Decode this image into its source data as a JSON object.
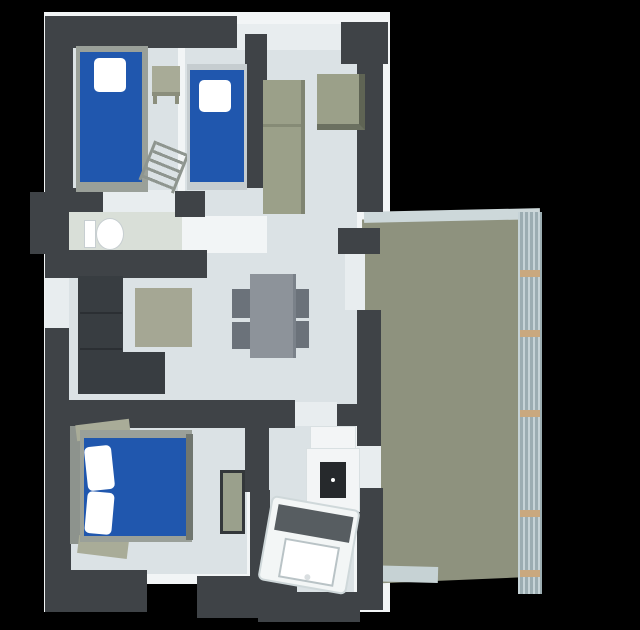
{
  "scene": {
    "type": "3d-floor-plan-render",
    "view": "top-down axonometric",
    "rooms": [
      {
        "name": "bedroom-top-left",
        "furniture": [
          "single-bed-blue",
          "white-pillow",
          "nightstand",
          "ladder"
        ]
      },
      {
        "name": "bedroom-top-middle",
        "furniture": [
          "single-bed-blue",
          "white-pillow"
        ]
      },
      {
        "name": "hallway-closet",
        "furniture": [
          "wardrobe-olive",
          "cabinet-olive"
        ]
      },
      {
        "name": "bathroom-small",
        "furniture": [
          "toilet"
        ]
      },
      {
        "name": "living-dining-room",
        "furniture": [
          "l-shaped-sofa-dark",
          "rug-olive",
          "dining-table",
          "chair",
          "chair",
          "chair",
          "chair"
        ]
      },
      {
        "name": "bedroom-bottom",
        "furniture": [
          "double-bed-blue",
          "white-pillow",
          "white-pillow",
          "bench-cabinet"
        ]
      },
      {
        "name": "kitchen",
        "furniture": [
          "counter",
          "cooktop"
        ]
      },
      {
        "name": "bathroom-bottom",
        "furniture": [
          "bathtub-diagonal",
          "faucet"
        ]
      },
      {
        "name": "terrace",
        "furniture": [
          "railing-slatted"
        ]
      }
    ]
  },
  "colors": {
    "bg": "#000000",
    "wall": "#3f4347",
    "wallLight": "#e8edef",
    "wallWhite": "#f2f5f6",
    "floor": "#dbe2e5",
    "floorBath": "#d9dfd8",
    "bedBlue": "#2057ae",
    "bedFrame": "#9aa099",
    "pillow": "#ffffff",
    "couch": "#383d41",
    "rug": "#a5a794",
    "olive": "#9ba089",
    "terrace": "#8e927e",
    "railing": "#cdd8da",
    "post": "#c9a87f",
    "table": "#8d939a",
    "chair": "#6b727a",
    "cooktop": "#26292c",
    "tubDeck": "#575d61"
  }
}
